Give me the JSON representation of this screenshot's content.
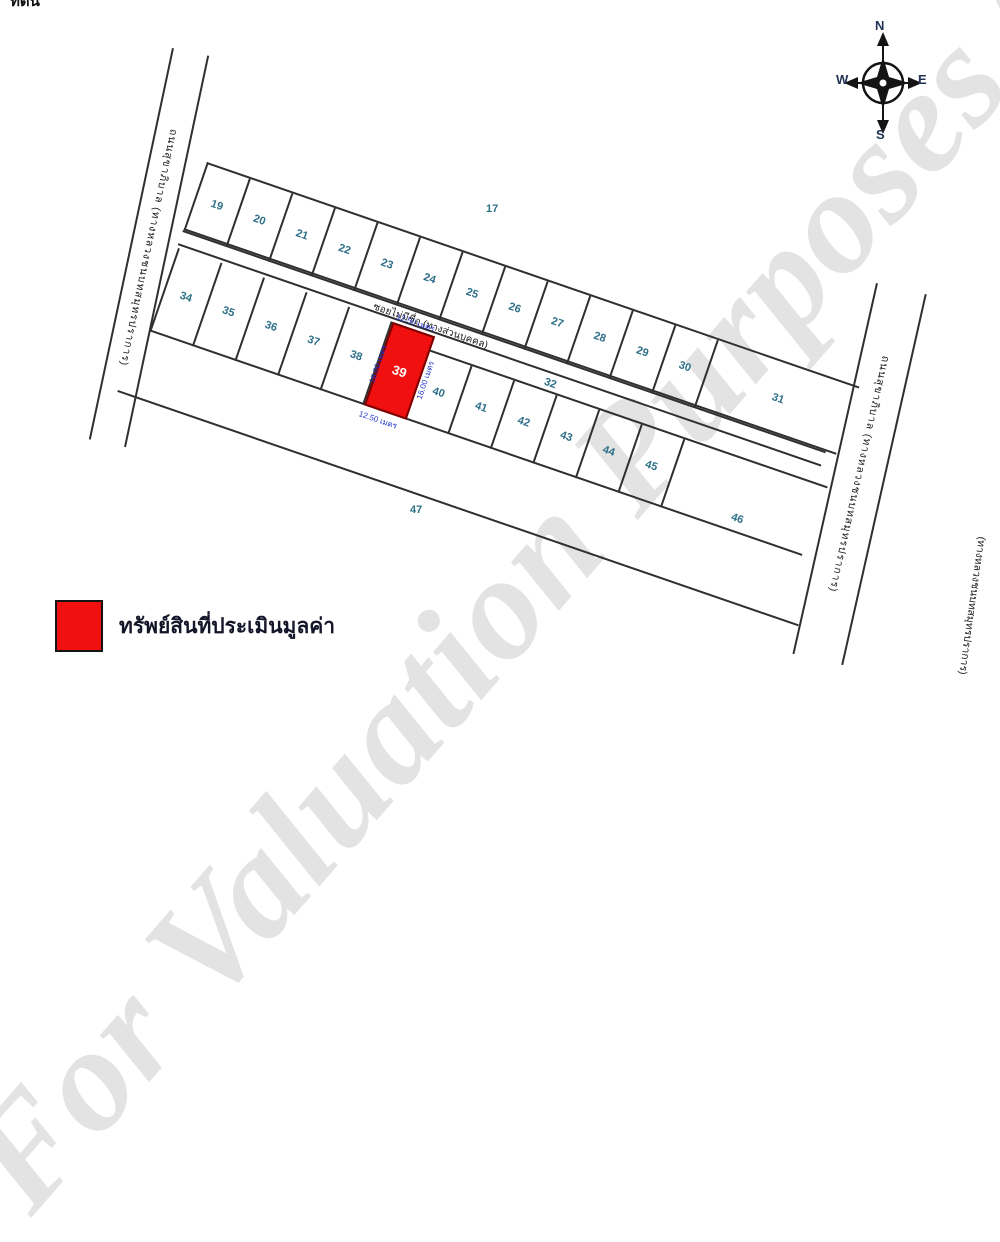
{
  "header": {
    "clipped_title": "ที่ดิน"
  },
  "watermark": {
    "text": "For Valuation Purposes Only"
  },
  "compass": {
    "north": "N",
    "east": "E",
    "south": "S",
    "west": "W"
  },
  "roads": {
    "left_road_label": "ถนนสุขาภิบาล (ทางหลวงชนบทสมุทรปราการ)",
    "right_road_label": "ถนนสุขาภิบาล (ทางหลวงชนบทสมุทรปราการ)",
    "right_road_label_bottom": "(ทางหลวงชนบทสมุทรปราการ)",
    "soi_label": "ซอยไม่มีชื่อ (ทางส่วนบุคคล)"
  },
  "plots": {
    "above_band1": "17",
    "band1_cells": [
      "19",
      "20",
      "21",
      "22",
      "23",
      "24",
      "25",
      "26",
      "27",
      "28",
      "29",
      "30"
    ],
    "band1_end": "31",
    "strip_between": "32",
    "band2_west_cells": [
      "34",
      "35",
      "36",
      "37",
      "38"
    ],
    "highlighted": "39",
    "band2_east_cells": [
      "40",
      "41",
      "42",
      "43",
      "44",
      "45"
    ],
    "band2_end": "46",
    "below_band2": "47"
  },
  "dimensions": {
    "top": "12.50 เมตร",
    "bottom": "12.50 เมตร",
    "left": "16.00 เมตร",
    "right": "16.00 เมตร"
  },
  "legend": {
    "label": "ทรัพย์สินที่ประเมินมูลค่า"
  },
  "colors": {
    "highlight": "#f01010",
    "plot_number": "#2e7088",
    "dimension_text": "#2233cc",
    "line": "#2f2f2f"
  }
}
